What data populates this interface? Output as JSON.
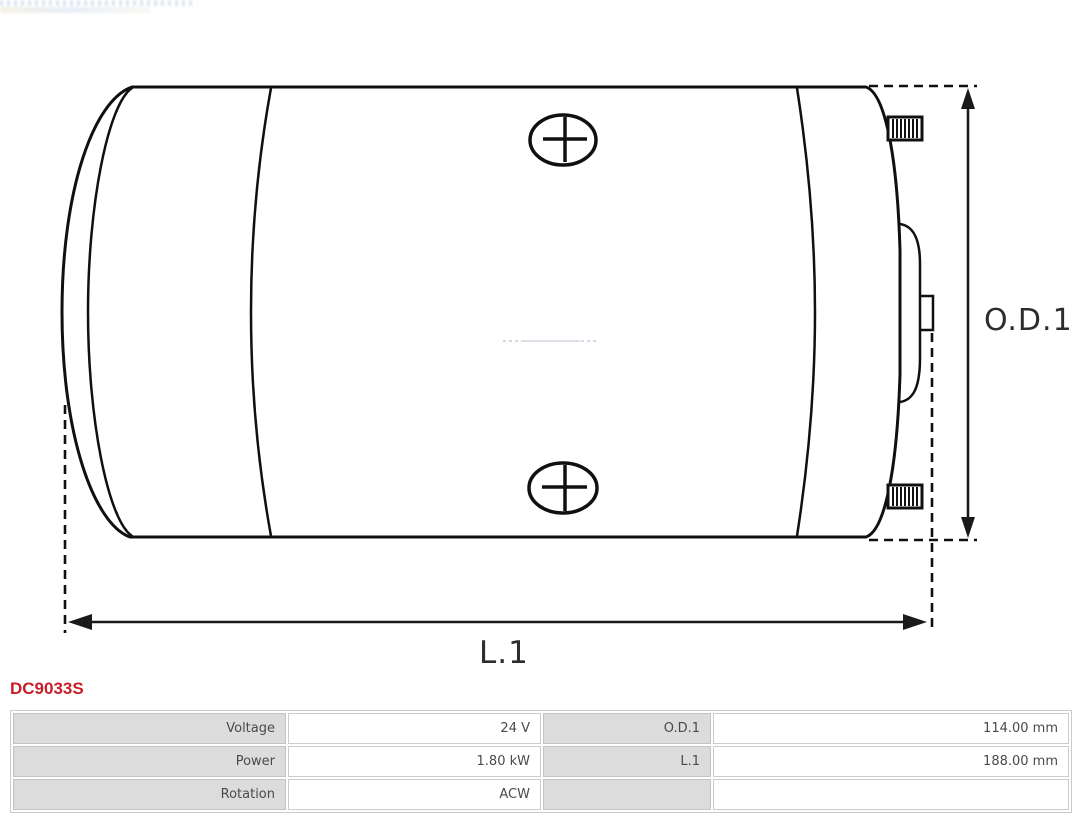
{
  "page": {
    "part_number": "DC9033S"
  },
  "drawing": {
    "type": "technical-drawing-dc-motor-side-view",
    "dimension_labels": {
      "od1": "O.D.1",
      "l1": "L.1"
    },
    "icons": {
      "screw_top": "phillips-screw-head-icon",
      "screw_bottom": "phillips-screw-head-icon",
      "stud_top": "threaded-terminal-stud-icon",
      "stud_bottom": "threaded-terminal-stud-icon"
    },
    "line_color": "#101010"
  },
  "spec_table": {
    "rows": [
      {
        "label_left": "Voltage",
        "value_left": "24 V",
        "label_right": "O.D.1",
        "value_right": "114.00 mm"
      },
      {
        "label_left": "Power",
        "value_left": "1.80 kW",
        "label_right": "L.1",
        "value_right": "188.00 mm"
      },
      {
        "label_left": "Rotation",
        "value_left": "ACW",
        "label_right": "",
        "value_right": ""
      }
    ],
    "colors": {
      "label_cell_bg": "#dcdcdc",
      "cell_border": "#c6c6c6",
      "text": "#4a4a4a"
    }
  },
  "colors": {
    "accent_red": "#c5202a",
    "background": "#ffffff"
  }
}
